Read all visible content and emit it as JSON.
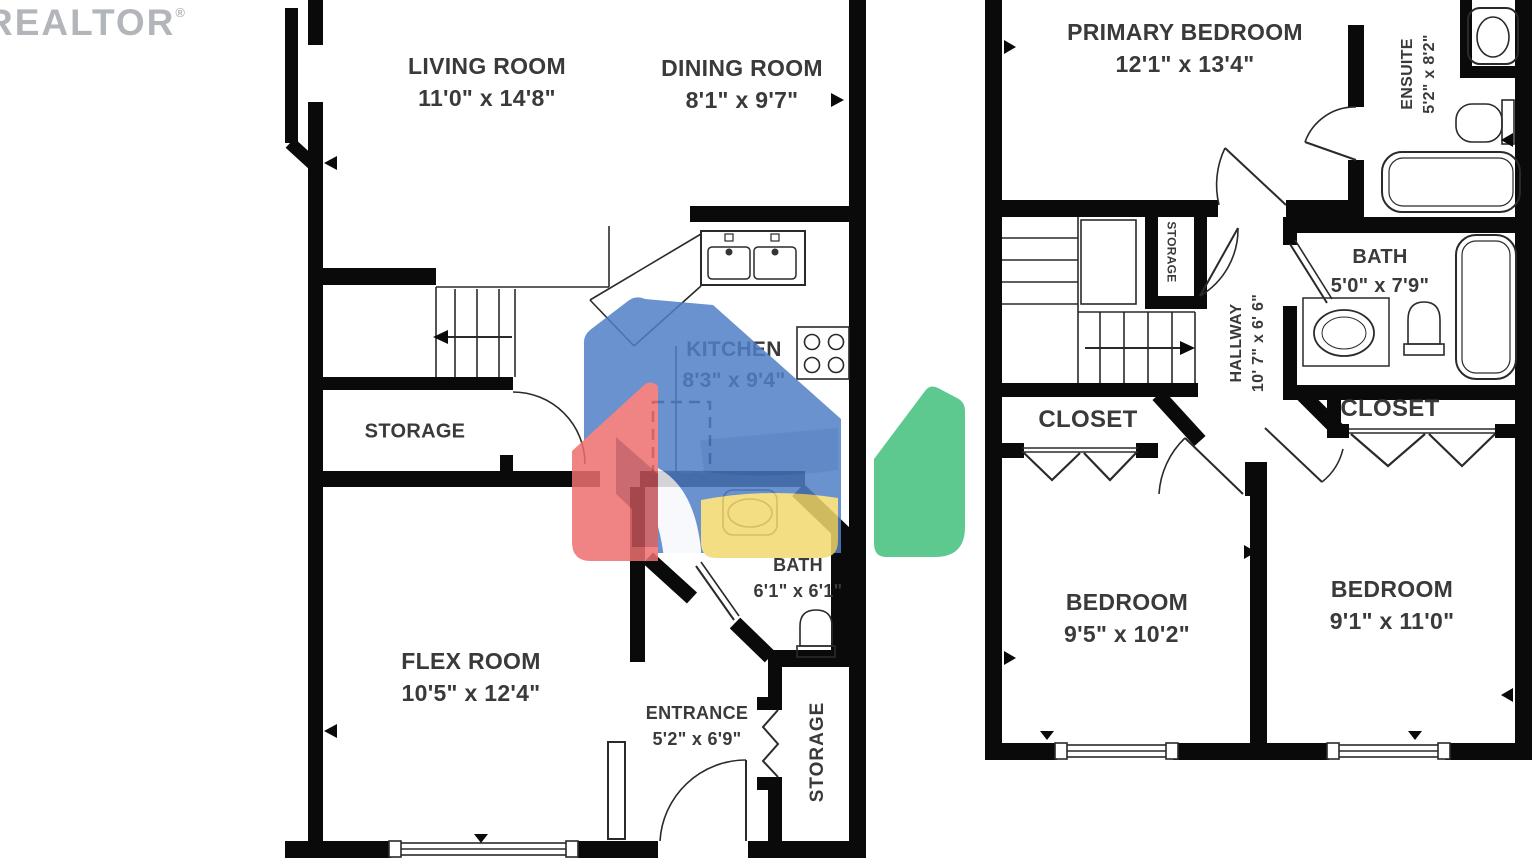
{
  "watermark": {
    "brand": "REALTOR",
    "reg": "®"
  },
  "logo_colors": {
    "red": "#ee6e6e",
    "red_dark": "#bc4f57",
    "blue": "#4f7fc7",
    "blue_dark": "#3d6bb4",
    "yellow": "#f3d96f",
    "green": "#41c07a"
  },
  "floor1": {
    "living_room": {
      "name": "LIVING ROOM",
      "dims": "11'0\" x 14'8\""
    },
    "dining_room": {
      "name": "DINING ROOM",
      "dims": "8'1\" x 9'7\""
    },
    "kitchen": {
      "name": "KITCHEN",
      "dims": "8'3\" x 9'4\""
    },
    "storage": {
      "name": "STORAGE"
    },
    "flex_room": {
      "name": "FLEX ROOM",
      "dims": "10'5\" x 12'4\""
    },
    "bath": {
      "name": "BATH",
      "dims": "6'1\" x 6'1\""
    },
    "entrance": {
      "name": "ENTRANCE",
      "dims": "5'2\" x 6'9\""
    },
    "storage_entry": {
      "name": "STORAGE"
    }
  },
  "floor2": {
    "primary_bedroom": {
      "name": "PRIMARY BEDROOM",
      "dims": "12'1\" x 13'4\""
    },
    "ensuite": {
      "name": "ENSUITE",
      "dims": "5'2\" x 8'2\""
    },
    "bath": {
      "name": "BATH",
      "dims": "5'0\" x 7'9\""
    },
    "hallway": {
      "name": "HALLWAY",
      "dims": "10' 7\" x 6' 6\""
    },
    "storage": {
      "name": "STORAGE"
    },
    "closet_left": {
      "name": "CLOSET"
    },
    "closet_right": {
      "name": "CLOSET"
    },
    "bedroom_left": {
      "name": "BEDROOM",
      "dims": "9'5\" x 10'2\""
    },
    "bedroom_right": {
      "name": "BEDROOM",
      "dims": "9'1\" x 11'0\""
    }
  }
}
